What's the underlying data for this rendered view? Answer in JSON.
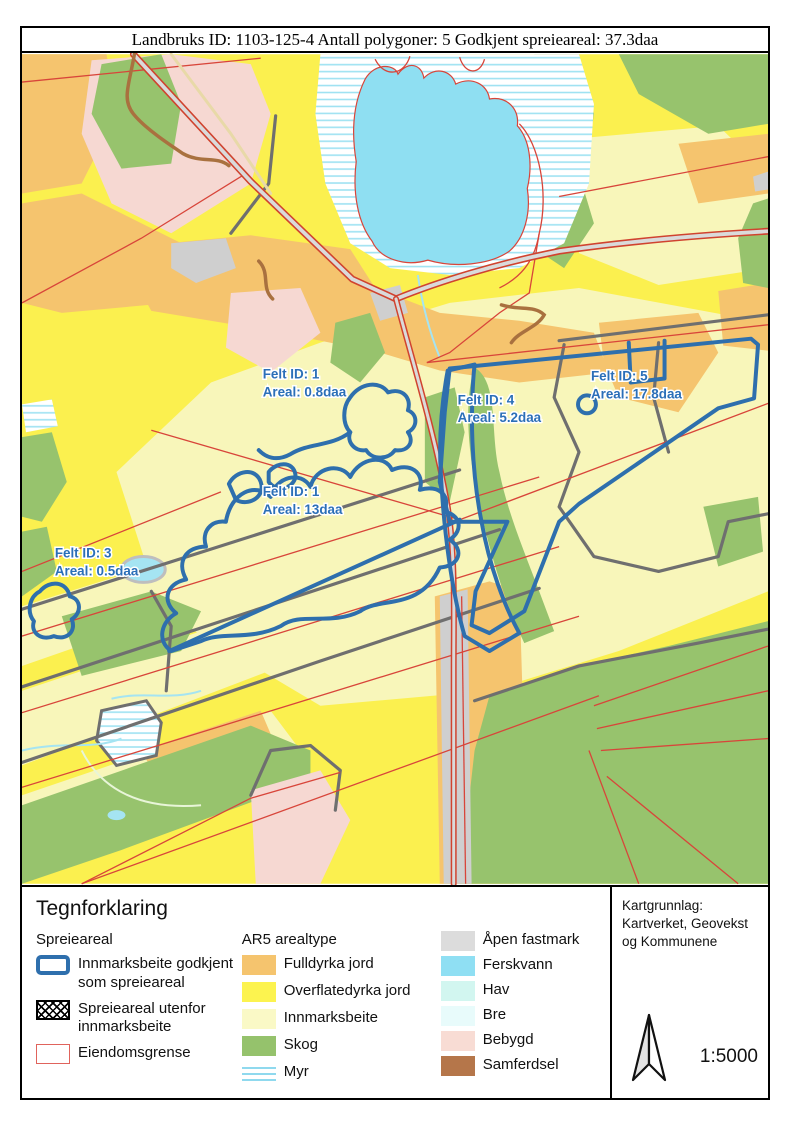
{
  "title_bar": {
    "text": "Landbruks ID: 1103-125-4 Antall polygoner: 5 Godkjent spreieareal: 37.3daa"
  },
  "map": {
    "labels": [
      {
        "name": "felt-1-small",
        "line1": "Felt ID: 1",
        "line2": "Areal: 0.8daa"
      },
      {
        "name": "felt-4",
        "line1": "Felt ID: 4",
        "line2": "Areal: 5.2daa"
      },
      {
        "name": "felt-5",
        "line1": "Felt ID: 5",
        "line2": "Areal: 17.8daa"
      },
      {
        "name": "felt-1-large",
        "line1": "Felt ID: 1",
        "line2": "Areal: 13daa"
      },
      {
        "name": "felt-3",
        "line1": "Felt ID: 3",
        "line2": "Areal: 0.5daa"
      }
    ]
  },
  "legend": {
    "title": "Tegnforklaring",
    "spreieareal": {
      "header": "Spreieareal",
      "items": [
        {
          "label": "Innmarksbeite godkjent som spreieareal",
          "swatch": "blue-outline",
          "color": "#2E6FAD"
        },
        {
          "label": "Spreieareal utenfor innmarksbeite",
          "swatch": "crosshatch",
          "color": "#000000"
        },
        {
          "label": "Eiendomsgrense",
          "swatch": "red-outline",
          "color": "#E0635C"
        }
      ]
    },
    "ar5": {
      "header": "AR5 arealtype",
      "items": [
        {
          "label": "Fulldyrka jord",
          "color": "#F5C46E"
        },
        {
          "label": "Overflatedyrka jord",
          "color": "#FCF34F"
        },
        {
          "label": "Innmarksbeite",
          "color": "#FAF9C6"
        },
        {
          "label": "Skog",
          "color": "#95C26C"
        },
        {
          "label": "Myr",
          "color": "#8FD9EE",
          "swatch": "myr-lines"
        }
      ]
    },
    "ar5_extra": {
      "items": [
        {
          "label": "Åpen fastmark",
          "color": "#DCDCDC"
        },
        {
          "label": "Ferskvann",
          "color": "#8FDFF3"
        },
        {
          "label": "Hav",
          "color": "#D2F6F0"
        },
        {
          "label": "Bre",
          "color": "#E8FBFB"
        },
        {
          "label": "Bebygd",
          "color": "#F8DCD4"
        },
        {
          "label": "Samferdsel",
          "color": "#B5764A"
        }
      ]
    }
  },
  "info_box": {
    "attribution": "Kartgrunnlag: Kartverket, Geovekst og Kommunene",
    "scale": "1:5000"
  }
}
